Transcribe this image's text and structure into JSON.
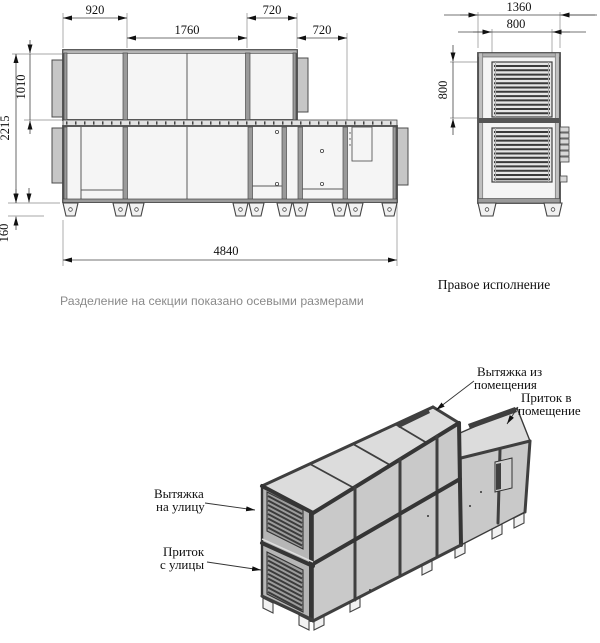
{
  "front_view": {
    "dims": {
      "w920": "920",
      "w1760": "1760",
      "w720a": "720",
      "w720b": "720",
      "h1010": "1010",
      "h2215": "2215",
      "h160": "160",
      "total": "4840"
    },
    "caption": "Разделение на секции показано осевыми размерами"
  },
  "side_view": {
    "dims": {
      "w1360": "1360",
      "w800": "800",
      "h800": "800"
    },
    "caption": "Правое исполнение"
  },
  "iso_view": {
    "labels": {
      "exhaust_room_line1": "Вытяжка из",
      "exhaust_room_line2": "помещения",
      "supply_room_line1": "Приток в",
      "supply_room_line2": "помещение",
      "exhaust_outdoor_line1": "Вытяжка",
      "exhaust_outdoor_line2": "на улицу",
      "supply_outdoor_line1": "Приток",
      "supply_outdoor_line2": "с улицы"
    }
  },
  "colors": {
    "line_dark": "#3c3c3c",
    "panel_light": "#f5f5f5",
    "panel_top": "#dcdcdc",
    "panel_side": "#c9c9c9",
    "panel_end": "#b6b6b6",
    "flange_gray": "#c6c6c6",
    "caption_gray": "#8a8a8a"
  }
}
